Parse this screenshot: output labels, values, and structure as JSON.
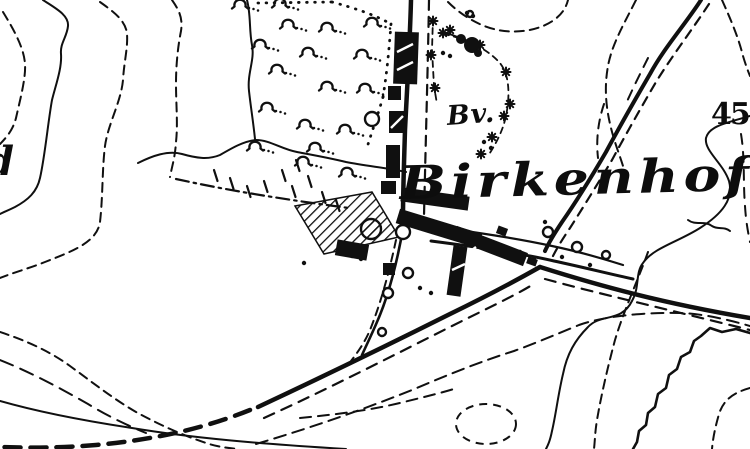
{
  "image_type": "scanned black-and-white historical topographic map excerpt",
  "colors": {
    "paper": "#ffffff",
    "ink": "#101010"
  },
  "labels": {
    "place": "Birkenhof",
    "hamlet_abbrev": "Bv.",
    "left_edge_fragment": "d",
    "right_edge_number": "45"
  },
  "map": {
    "contours_solid": [
      {
        "d": "M43,0 C55,8 69,15 68,26 C67,37 60,43 61,54 C62,68 56,84 52,100 C48,122 45,156 40,178 C37,192 28,200 15,207 C9,210 4,212 0,214"
      },
      {
        "d": "M0,401 C42,413 92,422 132,428 C192,438 262,444 346,449"
      },
      {
        "d": "M750,116 C726,123 709,126 706,138 C704,151 723,163 729,181 C734,199 722,214 700,228 C678,242 653,248 643,263 C635,273 640,287 632,301 C621,323 601,313 588,327 C575,340 567,354 563,374 C558,395 556,414 552,431 C550,441 548,445 546,449"
      },
      {
        "d": "M750,333 L736,329 L722,332 L710,328 L701,336 L694,341 L690,352 L681,357 L677,369 L669,375 L666,388 L658,394 L655,407 L648,413 L646,425 L639,431 L637,442 L633,449",
        "w": 2.6
      },
      {
        "d": "M688,220 C696,226 704,220 712,226 C718,230 724,226 730,231"
      },
      {
        "d": "M247,0 C251,15 249,30 252,45 C255,60 247,73 249,91 C251,109 253,120 255,139"
      },
      {
        "d": "M138,163 C152,156 168,150 182,154 C196,158 208,160 220,155 C232,148 244,141 256,140 C270,140 281,149 297,152 C313,155 330,158 346,162 C366,166 388,168 406,172"
      }
    ],
    "contours_dashed": [
      {
        "d": "M3,12 C14,30 24,48 25,64 C26,78 20,100 16,118 C13,130 6,138 0,144"
      },
      {
        "d": "M100,2 C114,12 126,21 127,34 C128,48 124,62 123,80 C121,102 108,124 105,146 C102,170 103,196 100,222 C97,243 70,252 45,262 C30,268 12,273 0,278"
      },
      {
        "d": "M172,0 C179,10 183,18 181,31 C178,46 176,64 176,84 C176,104 178,124 176,142 C175,158 172,166 170,177"
      },
      {
        "d": "M448,2 C460,14 478,26 498,30 C518,34 540,30 554,20 C562,14 566,8 568,0"
      },
      {
        "d": "M722,0 C730,18 738,36 743,56 C746,66 748,71 750,76"
      },
      {
        "d": "M636,0 C624,24 612,44 608,66 C604,88 606,108 611,128 C615,144 620,156 623,166"
      },
      {
        "d": "M741,134 C745,158 743,182 745,206 C746,222 748,232 750,242",
        "dash": "10 8"
      },
      {
        "d": "M648,252 C638,280 624,310 615,340 C608,366 601,396 597,420 C595,432 595,440 594,449"
      },
      {
        "d": "M750,388 C736,392 724,398 719,414 C715,428 713,438 712,449"
      },
      {
        "d": "M0,332 C24,340 48,350 70,366 C92,382 112,398 136,412 C158,424 182,435 206,443 C218,447 228,448 238,449"
      },
      {
        "d": "M0,360 C30,372 60,388 88,404 C106,415 124,424 146,433",
        "dash": "14 8"
      },
      {
        "d": "M256,444 C310,428 362,410 412,390 C452,373 482,361 514,351 C536,343 557,334 579,325 C601,317 641,312 681,313 C705,314 729,320 750,326",
        "dash": "12 7"
      },
      {
        "d": "M300,418 C340,414 372,410 404,402 C424,397 441,393 457,388",
        "dash": "11 7"
      },
      {
        "d": "M604,104 C598,122 596,140 598,158",
        "dash": "9 7"
      },
      {
        "d": "M648,58 C640,74 632,90 625,106",
        "dash": "10 8"
      }
    ],
    "closed_depression": {
      "cx": 486,
      "cy": 424,
      "rx": 30,
      "ry": 20,
      "dash": "8 6"
    },
    "dotted_boundaries": [
      {
        "d": "M258,3 L332,2"
      },
      {
        "d": "M332,2 C354,8 373,14 391,24"
      },
      {
        "d": "M391,24 C389,50 387,72 383,97"
      },
      {
        "d": "M383,97 C377,118 371,134 366,151"
      }
    ],
    "dashdot_boundaries": [
      {
        "d": "M176,179 C235,192 296,201 349,208"
      }
    ],
    "roads_solid": [
      {
        "d": "M411,0 C410,40 407,90 405,130 C404,165 403,190 403,216",
        "w": 4.5
      },
      {
        "d": "M403,228 C398,258 389,295 377,322 C371,336 366,346 362,355",
        "w": 2.6
      },
      {
        "d": "M258,407 C320,378 390,344 450,314 C487,296 517,280 540,267",
        "w": 4.5
      },
      {
        "d": "M540,267 C600,286 662,303 750,318",
        "w": 4.5
      },
      {
        "d": "M701,0 C684,26 664,48 650,74 C636,98 620,126 606,152 C592,176 576,202 562,222 C556,231 550,240 545,251",
        "w": 4
      },
      {
        "d": "M433,227 C470,231 520,239 552,246 C576,251 601,258 623,265",
        "w": 2.2
      },
      {
        "d": "M431,241 C470,246 520,253 554,261 C582,267 606,273 633,279",
        "w": 3
      },
      {
        "d": "M447,33 L476,44",
        "w": 2
      }
    ],
    "roads_dashed": [
      {
        "d": "M429,0 C428,60 426,130 424,216",
        "w": 2.2,
        "dash": "10 7"
      },
      {
        "d": "M396,240 C390,268 382,300 370,330 C364,344 357,353 351,361",
        "w": 2,
        "dash": "8 6"
      },
      {
        "d": "M250,410 C200,430 150,440 96,445 C60,448 30,448 0,447",
        "w": 4.5,
        "dash": "16 10"
      },
      {
        "d": "M264,418 C330,388 392,356 452,326 C488,308 514,296 532,285",
        "w": 2.2,
        "dash": "11 8"
      },
      {
        "d": "M545,279 C600,294 662,308 750,330",
        "w": 2.2,
        "dash": "11 8"
      },
      {
        "d": "M709,4 C692,30 672,56 656,82 C642,106 626,134 612,160 C600,180 584,206 570,228 C564,237 558,246 553,256",
        "w": 2.2,
        "dash": "9 7"
      }
    ],
    "fences": [
      {
        "d": "M433,17 L432,50 L434,86 L437,104"
      },
      {
        "d": "M443,34 C465,38 486,48 499,62 C510,74 510,96 506,116 C503,130 497,142 488,156"
      }
    ],
    "hatch_polygon": "295,206 372,192 399,237 324,254",
    "hatch_dark_rect": {
      "x": 336,
      "y": 242,
      "w": 32,
      "h": 16,
      "rot": 10
    },
    "buildings": [
      {
        "x": 394,
        "y": 32,
        "w": 24,
        "h": 52,
        "rot": 2
      },
      {
        "x": 388,
        "y": 86,
        "w": 13,
        "h": 14,
        "rot": 0
      },
      {
        "x": 389,
        "y": 111,
        "w": 16,
        "h": 22,
        "rot": 0
      },
      {
        "x": 386,
        "y": 145,
        "w": 14,
        "h": 33,
        "rot": 0
      },
      {
        "x": 381,
        "y": 181,
        "w": 15,
        "h": 13,
        "rot": 0
      },
      {
        "x": 401,
        "y": 192,
        "w": 68,
        "h": 14,
        "rot": 8
      },
      {
        "x": 396,
        "y": 221,
        "w": 86,
        "h": 15,
        "rot": 17
      },
      {
        "x": 452,
        "y": 239,
        "w": 76,
        "h": 14,
        "rot": 21
      },
      {
        "x": 450,
        "y": 246,
        "w": 14,
        "h": 50,
        "rot": 8
      },
      {
        "x": 497,
        "y": 227,
        "w": 10,
        "h": 8,
        "rot": 20
      },
      {
        "x": 383,
        "y": 263,
        "w": 12,
        "h": 12,
        "rot": 0
      },
      {
        "x": 527,
        "y": 258,
        "w": 10,
        "h": 7,
        "rot": 20
      }
    ],
    "building_slashes": [
      [
        397,
        52,
        413,
        44
      ],
      [
        397,
        70,
        413,
        62
      ],
      [
        391,
        128,
        403,
        116
      ],
      [
        452,
        270,
        465,
        264
      ],
      [
        468,
        253,
        476,
        247
      ]
    ],
    "tree_clump_blobs": [
      [
        472,
        45,
        8
      ],
      [
        461,
        39,
        5
      ],
      [
        478,
        53,
        4
      ]
    ],
    "circles": [
      {
        "cx": 372,
        "cy": 119,
        "r": 7
      },
      {
        "cx": 371,
        "cy": 229,
        "r": 10,
        "hatched": true
      },
      {
        "cx": 403,
        "cy": 232,
        "r": 7
      },
      {
        "cx": 548,
        "cy": 232,
        "r": 5
      },
      {
        "cx": 577,
        "cy": 247,
        "r": 5
      },
      {
        "cx": 606,
        "cy": 255,
        "r": 4
      },
      {
        "cx": 408,
        "cy": 273,
        "r": 5
      },
      {
        "cx": 388,
        "cy": 293,
        "r": 5
      },
      {
        "cx": 382,
        "cy": 332,
        "r": 4
      },
      {
        "cx": 470,
        "cy": 14,
        "r": 3
      }
    ],
    "orchard_trees": [
      [
        240,
        4
      ],
      [
        280,
        3
      ],
      [
        288,
        24
      ],
      [
        327,
        27
      ],
      [
        372,
        22
      ],
      [
        260,
        44
      ],
      [
        308,
        52
      ],
      [
        362,
        54
      ],
      [
        277,
        69
      ],
      [
        327,
        86
      ],
      [
        365,
        88
      ],
      [
        267,
        107
      ],
      [
        305,
        124
      ],
      [
        345,
        129
      ],
      [
        255,
        146
      ],
      [
        315,
        147
      ],
      [
        303,
        161
      ],
      [
        347,
        172
      ]
    ],
    "stars": [
      [
        433,
        21
      ],
      [
        431,
        55
      ],
      [
        435,
        88
      ],
      [
        443,
        33
      ],
      [
        480,
        45
      ],
      [
        506,
        72
      ],
      [
        504,
        116
      ],
      [
        492,
        137
      ],
      [
        481,
        154
      ],
      [
        450,
        30
      ],
      [
        510,
        104
      ]
    ],
    "hachures": [
      [
        214,
        170
      ],
      [
        230,
        178
      ],
      [
        247,
        186
      ],
      [
        264,
        181
      ],
      [
        282,
        170
      ],
      [
        292,
        186
      ],
      [
        308,
        176
      ],
      [
        322,
        192
      ],
      [
        336,
        200
      ],
      [
        296,
        160
      ]
    ],
    "dots": [
      [
        520,
        252
      ],
      [
        534,
        259
      ],
      [
        562,
        257
      ],
      [
        590,
        265
      ],
      [
        545,
        222
      ],
      [
        352,
        256
      ],
      [
        361,
        259
      ],
      [
        420,
        288
      ],
      [
        431,
        293
      ],
      [
        443,
        53
      ],
      [
        450,
        56
      ],
      [
        467,
        13
      ],
      [
        473,
        16
      ],
      [
        484,
        142
      ],
      [
        491,
        148
      ],
      [
        304,
        263
      ]
    ]
  }
}
